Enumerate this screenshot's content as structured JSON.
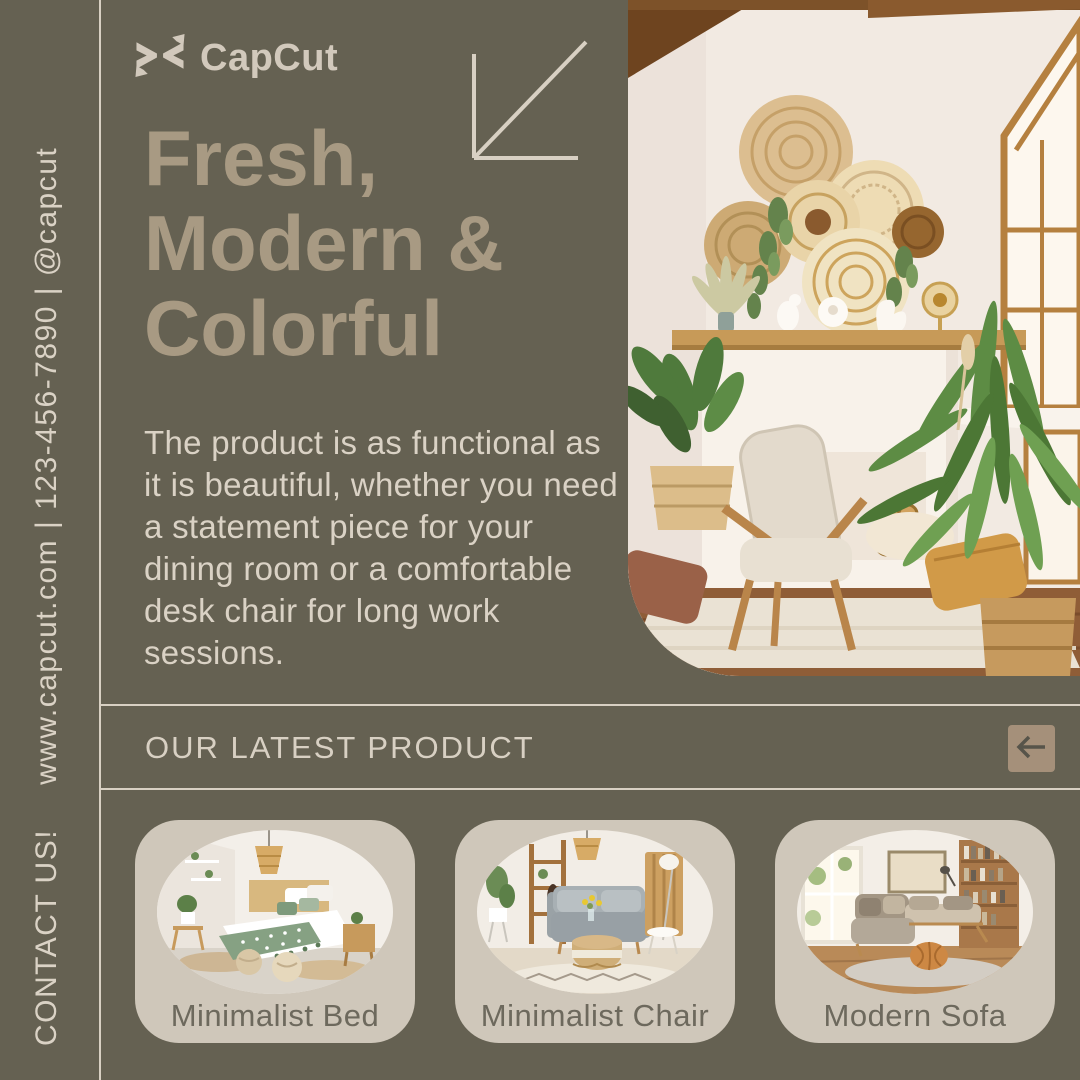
{
  "brand": {
    "name": "CapCut"
  },
  "sidebar": {
    "contact": "CONTACT US!",
    "info": "www.capcut.com | 123-456-7890 | @capcut"
  },
  "hero": {
    "title_lines": [
      "Fresh,",
      "Modern &",
      "Colorful"
    ],
    "body": "The product is as functional as it is beautiful, whether you need a statement piece for your dining room or a comfortable desk chair for long work sessions."
  },
  "section": {
    "label": "OUR LATEST PRODUCT"
  },
  "products": [
    {
      "label": "Minimalist Bed"
    },
    {
      "label": "Minimalist Chair"
    },
    {
      "label": "Modern Sofa"
    }
  ],
  "icons": {
    "logo": "capcut-logo-icon",
    "decoration": "arrow-down-left-icon",
    "back_button": "arrow-left-icon"
  },
  "colors": {
    "background": "#656152",
    "rule": "#d8d0c3",
    "heading": "#a89a83",
    "body_text": "#dad2c5",
    "card_bg": "#cfc7ba",
    "card_label": "#6d695d",
    "button_bg": "#a5907a",
    "button_icon": "#57544a",
    "logo": "#d2c9bc"
  }
}
